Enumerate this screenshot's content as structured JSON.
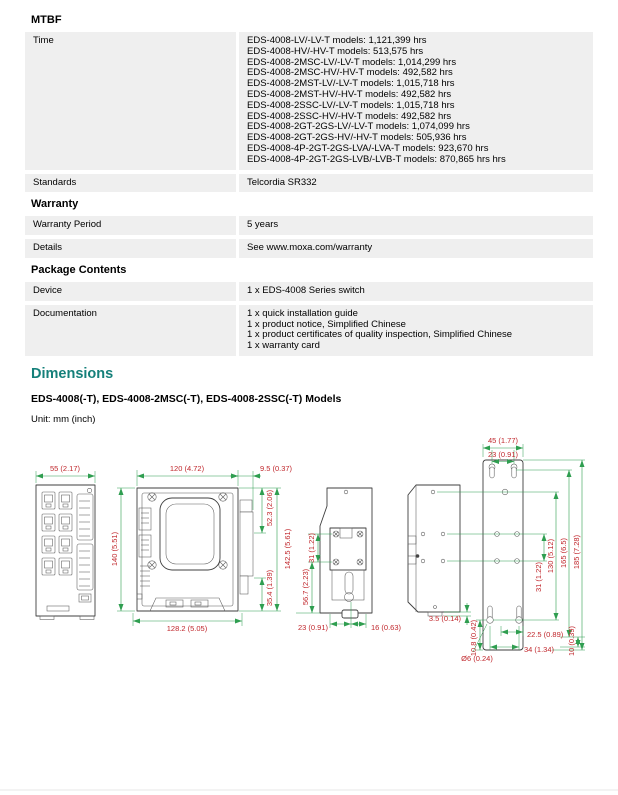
{
  "colors": {
    "heading_accent": "#15807a",
    "dimension_text": "#c0272c",
    "dimension_line": "#2f9e50",
    "row_background": "#efefef"
  },
  "mtbf": {
    "heading": "MTBF",
    "rows": [
      {
        "label": "Time",
        "lines": [
          "EDS-4008-LV/-LV-T models: 1,121,399 hrs",
          "EDS-4008-HV/-HV-T models: 513,575 hrs",
          "EDS-4008-2MSC-LV/-LV-T models: 1,014,299 hrs",
          "EDS-4008-2MSC-HV/-HV-T models: 492,582 hrs",
          "EDS-4008-2MST-LV/-LV-T models: 1,015,718 hrs",
          "EDS-4008-2MST-HV/-HV-T models: 492,582 hrs",
          "EDS-4008-2SSC-LV/-LV-T models: 1,015,718 hrs",
          "EDS-4008-2SSC-HV/-HV-T models: 492,582 hrs",
          "EDS-4008-2GT-2GS-LV/-LV-T models: 1,074,099 hrs",
          "EDS-4008-2GT-2GS-HV/-HV-T models: 505,936 hrs",
          "EDS-4008-4P-2GT-2GS-LVA/-LVA-T models: 923,670 hrs",
          "EDS-4008-4P-2GT-2GS-LVB/-LVB-T models: 870,865 hrs hrs"
        ]
      },
      {
        "label": "Standards",
        "lines": [
          "Telcordia SR332"
        ]
      }
    ]
  },
  "warranty": {
    "heading": "Warranty",
    "rows": [
      {
        "label": "Warranty Period",
        "lines": [
          "5 years"
        ]
      },
      {
        "label": "Details",
        "lines": [
          "See www.moxa.com/warranty"
        ]
      }
    ]
  },
  "package_contents": {
    "heading": "Package Contents",
    "rows": [
      {
        "label": "Device",
        "lines": [
          "1 x EDS-4008 Series switch"
        ]
      },
      {
        "label": "Documentation",
        "lines": [
          "1 x quick installation guide",
          "1 x product notice, Simplified Chinese",
          "1 x product certificates of quality inspection, Simplified Chinese",
          "1 x warranty card"
        ]
      }
    ]
  },
  "dimensions": {
    "heading": "Dimensions",
    "models_title": "EDS-4008(-T), EDS-4008-2MSC(-T), EDS-4008-2SSC(-T) Models",
    "unit_label": "Unit: mm (inch)",
    "labels": {
      "d55": "55 (2.17)",
      "d140": "140 (5.51)",
      "d120": "120 (4.72)",
      "d9_5": "9.5 (0.37)",
      "d52_3": "52.3 (2.06)",
      "d142_5": "142.5 (5.61)",
      "d35_4": "35.4 (1.39)",
      "d128_2": "128.2 (5.05)",
      "d56_7": "56.7 (2.23)",
      "d31_back": "31 (1.22)",
      "d23_back": "23 (0.91)",
      "d16": "16 (0.63)",
      "d3_5": "3.5 (0.14)",
      "d45": "45 (1.77)",
      "d23_plate": "23 (0.91)",
      "d130": "130 (5.12)",
      "d165": "165 (6.5)",
      "d185": "185 (7.28)",
      "d31_plate": "31 (1.22)",
      "d10_8": "10.8 (0.42)",
      "dia6": "Ø6 (0.24)",
      "d22_5": "22.5 (0.89)",
      "d34": "34 (1.34)",
      "d10": "10 (0.39)"
    }
  }
}
